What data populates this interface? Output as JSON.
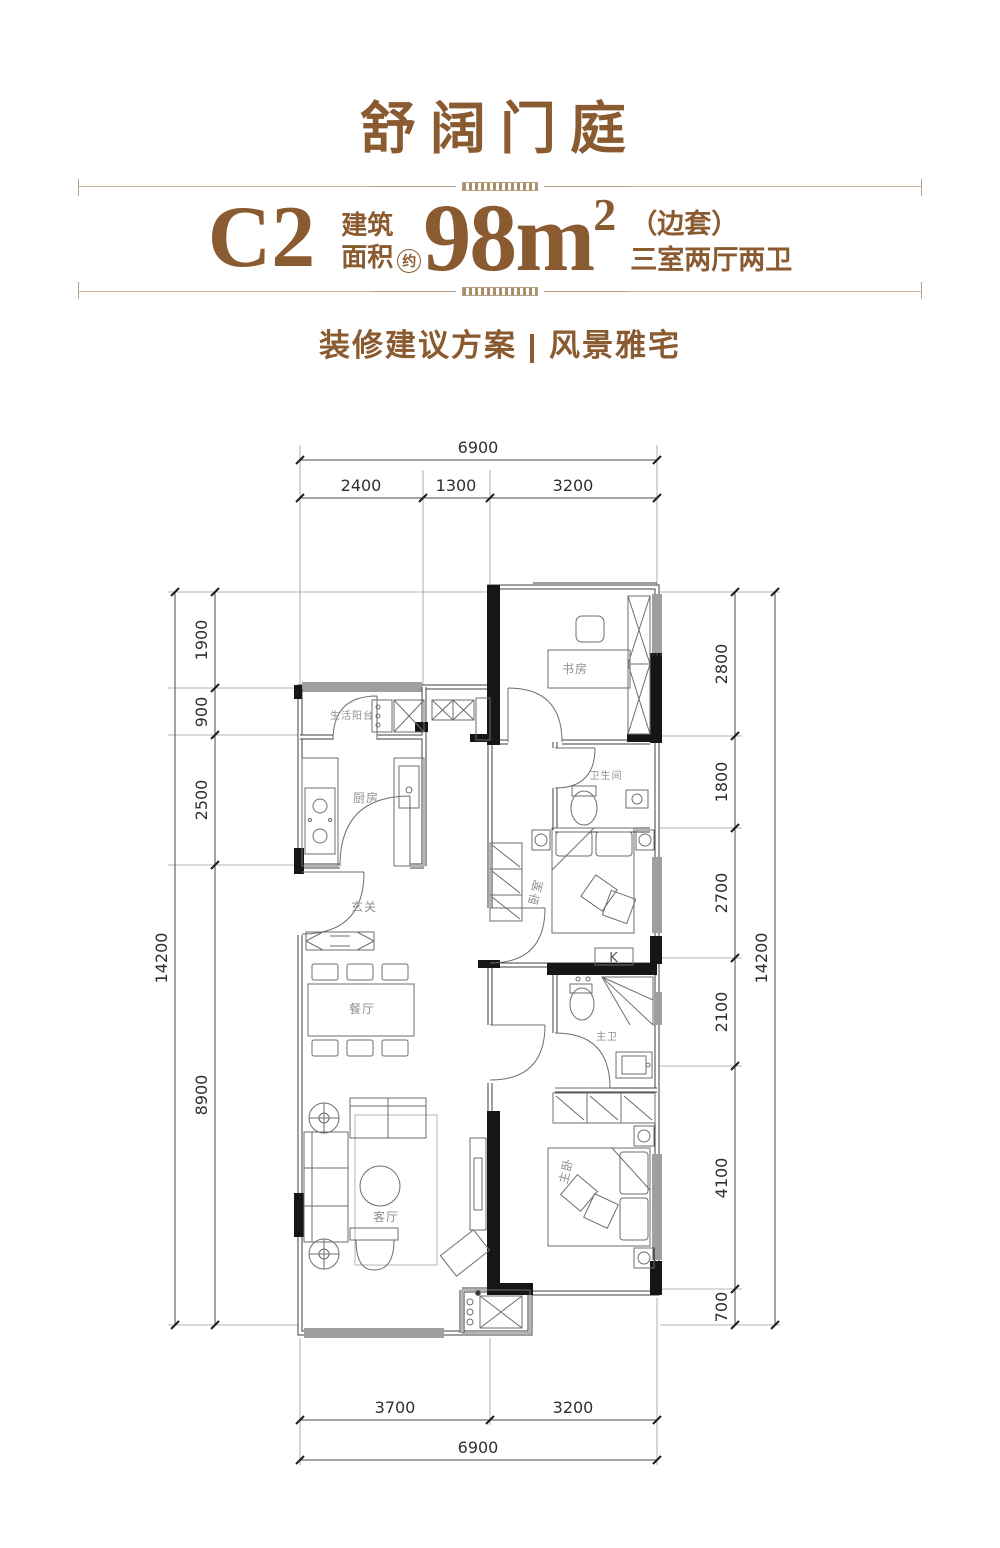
{
  "header": {
    "title": "舒阔门庭",
    "unit_code": "C2",
    "area_label_top": "建筑",
    "area_label_bottom": "面积",
    "area_approx": "约",
    "area_value": "98m",
    "area_sup": "2",
    "unit_position": "（边套）",
    "unit_layout": "三室两厅两卫",
    "subtitle": "装修建议方案 | 风景雅宅",
    "accent_color": "#8a5a30"
  },
  "plan": {
    "rooms": {
      "study": "书房",
      "service_balcony": "生活阳台",
      "kitchen": "厨房",
      "bathroom": "卫生间",
      "bedroom": "卧室",
      "foyer": "玄关",
      "dining": "餐厅",
      "master_bath": "主卫",
      "living": "客厅",
      "master_bedroom": "主卧",
      "closet_mark": "K"
    },
    "dims": {
      "top_total": "6900",
      "top_segments": [
        "2400",
        "1300",
        "3200"
      ],
      "left_segments": [
        "1900",
        "900",
        "2500",
        "8900"
      ],
      "left_total": "14200",
      "right_segments": [
        "2800",
        "1800",
        "2700",
        "2100",
        "4100",
        "700"
      ],
      "right_total": "14200",
      "bottom_segments": [
        "3700",
        "3200"
      ],
      "bottom_total": "6900"
    },
    "line_color": "#3f3f3f",
    "wall_fill": "#161616"
  }
}
